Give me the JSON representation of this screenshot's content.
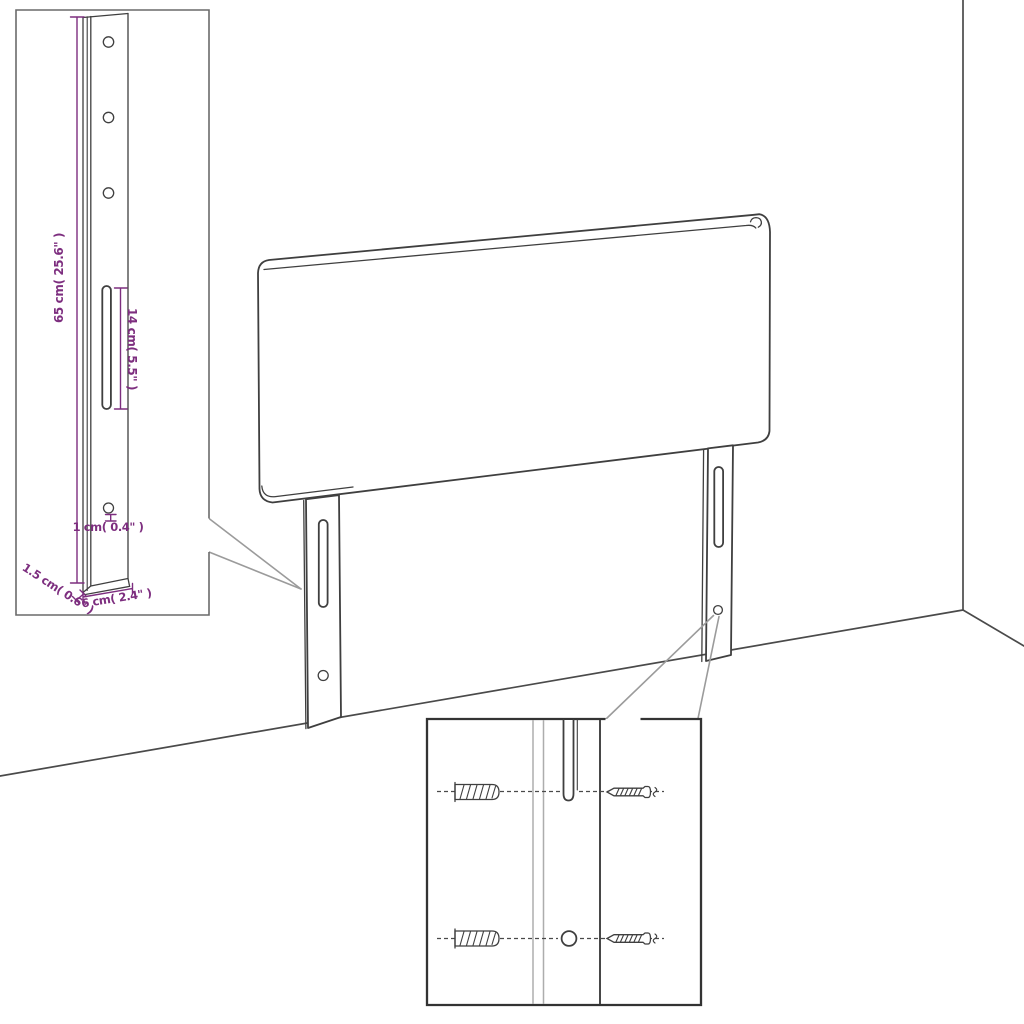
{
  "colors": {
    "background": "#ffffff",
    "line": "#3f3f3f",
    "room_line": "#4a4a4a",
    "dimension": "#7d2e7f",
    "callout": "#9b9b9b",
    "inset_border": "#6a6a6a",
    "detail_border": "#333333",
    "light_line": "#adadad"
  },
  "leg_detail": {
    "height": "65 cm( 25.6\" )",
    "slot_length": "14 cm( 5.5\" )",
    "hole_diameter": "1 cm( 0.4\" )",
    "thickness": "1.5 cm( 0.6\" )",
    "width": "6 cm( 2.4\" )"
  }
}
